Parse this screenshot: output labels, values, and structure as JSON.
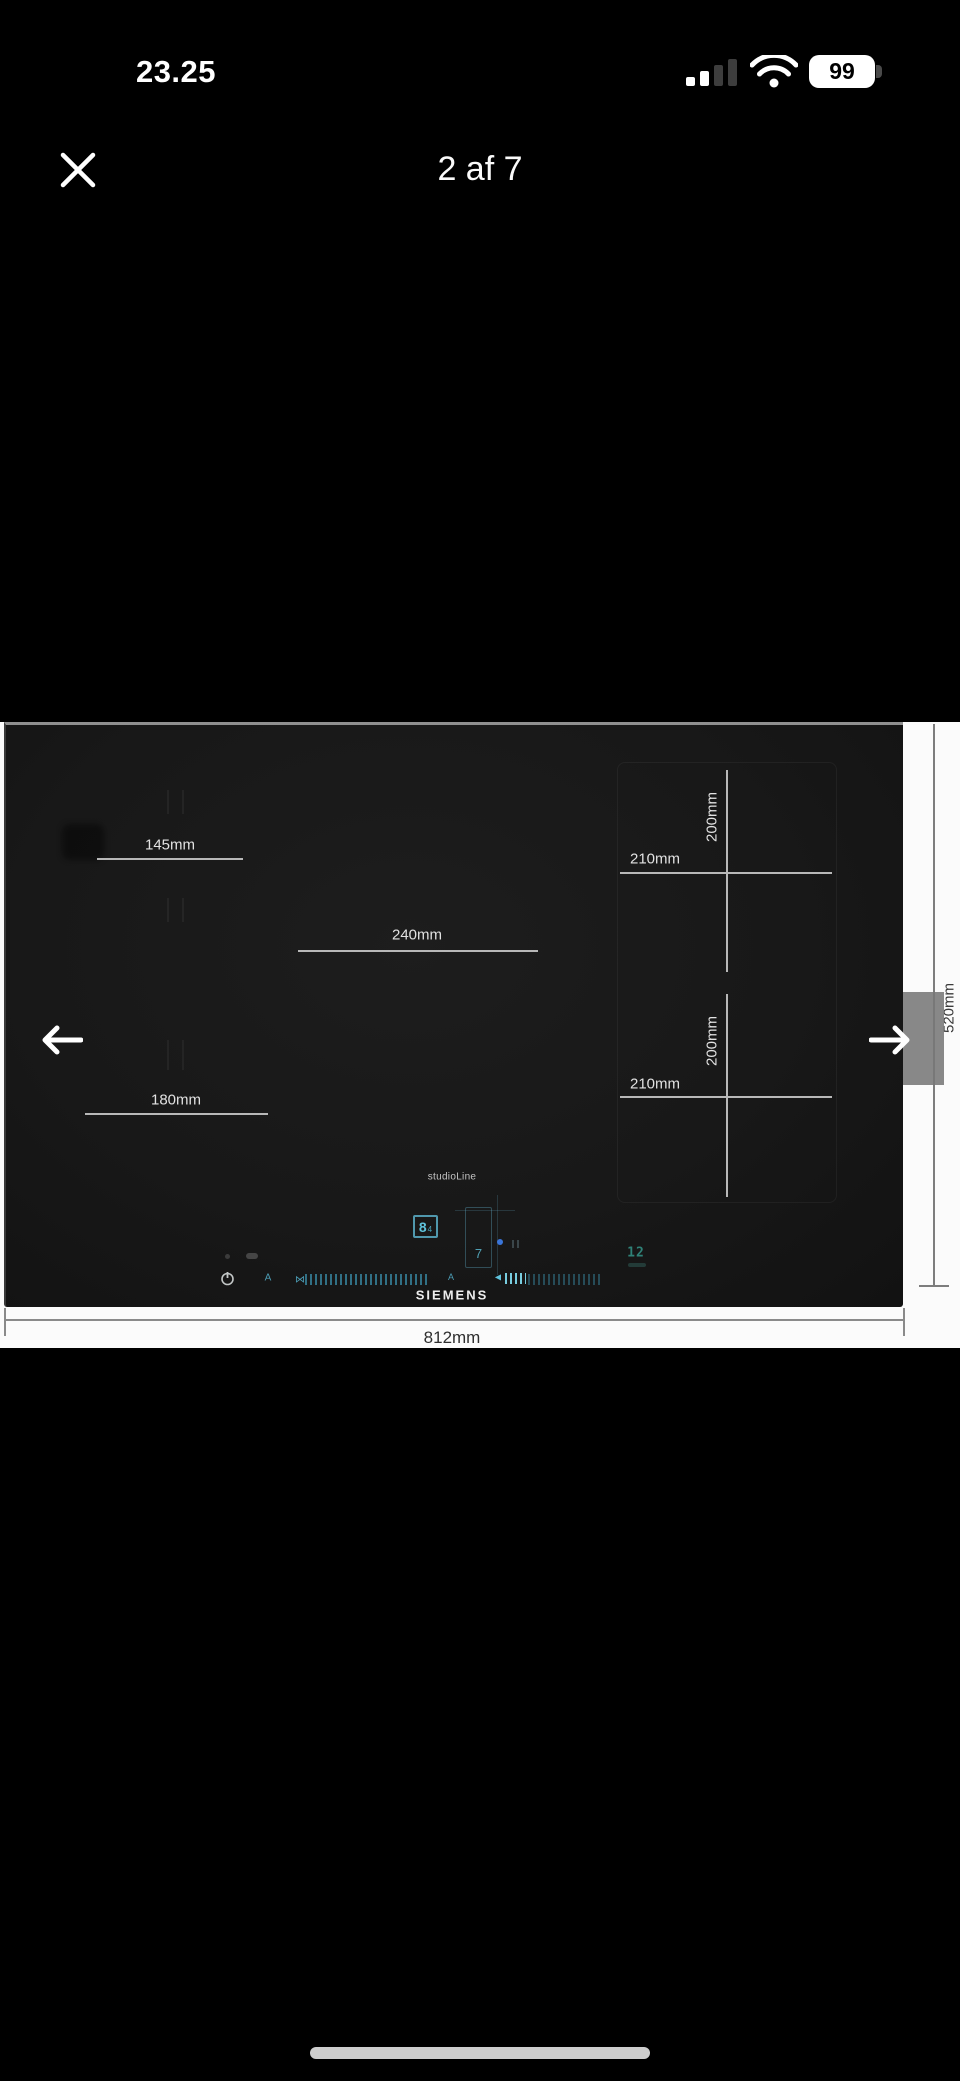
{
  "status_bar": {
    "time": "23.25",
    "battery": "99"
  },
  "header": {
    "page_indicator": "2 af 7"
  },
  "viewer": {
    "dimensions": {
      "left_rear_zone_width": "145mm",
      "center_zone_width": "240mm",
      "left_front_zone_width": "180mm",
      "flex_rear_zone_width": "210mm",
      "flex_rear_zone_depth": "200mm",
      "flex_front_zone_width": "210mm",
      "flex_front_zone_depth": "200mm",
      "hob_total_width": "812mm",
      "hob_total_depth": "520mm"
    },
    "control_panel": {
      "series": "studioLine",
      "brand": "SIEMENS",
      "power_level_display": "8",
      "power_level_sub": "4",
      "zone_display": "7",
      "timer_display": "12"
    },
    "colors": {
      "accent_cyan": "#5fc3dc",
      "timer_teal": "#2f8177",
      "photo_background": "#fbfbfb",
      "hob_surface": "#181818",
      "dimension_line_dark_bg": "#b8b8b8",
      "dimension_line_light_bg": "#7d7d7d"
    }
  }
}
